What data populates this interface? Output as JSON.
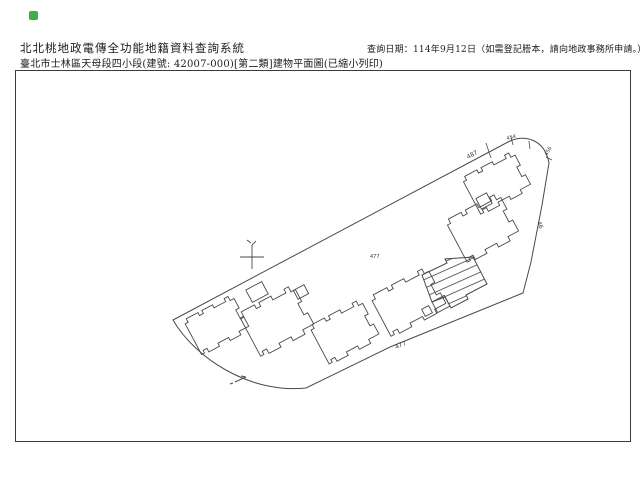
{
  "header": {
    "system_title": "北北桃地政電傳全功能地籍資料查詢系統",
    "document_title": "臺北市士林區天母段四小段(建號: 42007-000)[第二類]建物平面圖(已縮小列印)",
    "query_date_note": "查詢日期：114年9月12日（如需登記謄本，請向地政事務所申請。）"
  },
  "icons": {
    "app_icon_color": "#3fae49"
  },
  "colors": {
    "line": "#4a4a4a",
    "frame": "#3b3b3b",
    "text": "#1c1c1c"
  },
  "map": {
    "description": "建物平面圖 line drawing",
    "labels": [
      {
        "text": "487",
        "x": 468,
        "y": 159,
        "size": 6,
        "rot": -28
      },
      {
        "text": "454",
        "x": 507,
        "y": 140,
        "size": 5,
        "rot": -15
      },
      {
        "text": "456",
        "x": 547,
        "y": 156,
        "size": 5,
        "rot": -60
      },
      {
        "text": "46",
        "x": 537,
        "y": 222,
        "size": 6,
        "rot": 70
      },
      {
        "text": "477",
        "x": 370,
        "y": 258,
        "size": 5,
        "rot": 0
      },
      {
        "text": "477",
        "x": 396,
        "y": 349,
        "size": 6,
        "rot": -23
      }
    ]
  }
}
